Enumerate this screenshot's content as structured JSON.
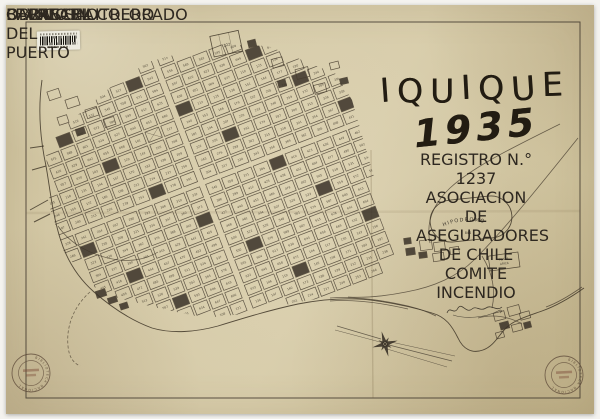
{
  "title": {
    "city": "IQUIQUE",
    "year": "1935"
  },
  "attribution": {
    "registro": "REGISTRO N.° 1237",
    "organization": "ASOCIACION DE ASEGURADORES DE CHILE",
    "committee": "COMITE INCENDIO"
  },
  "labels": {
    "hipodromo": "HIPODROMO",
    "hipodromo_number": "844",
    "cavancha": "CAVANCHA",
    "balneario": "BALNEARIO",
    "barrio": "BARRIO EL COLORADO",
    "ferrocarril": "FF.C.C. SALITRERO",
    "obras_1": "OBRAS",
    "obras_2": "DEL",
    "obras_3": "PUERTO",
    "plaza_1": "PLAZA",
    "plaza_2": "ARICA",
    "cemetery_number": "222"
  },
  "stamps": {
    "ring_text": "BIBLIOTECA NACIONAL"
  },
  "colors": {
    "paper": "#d3c8a5",
    "ink": "#2e2820",
    "stamp": "#5a4635"
  }
}
